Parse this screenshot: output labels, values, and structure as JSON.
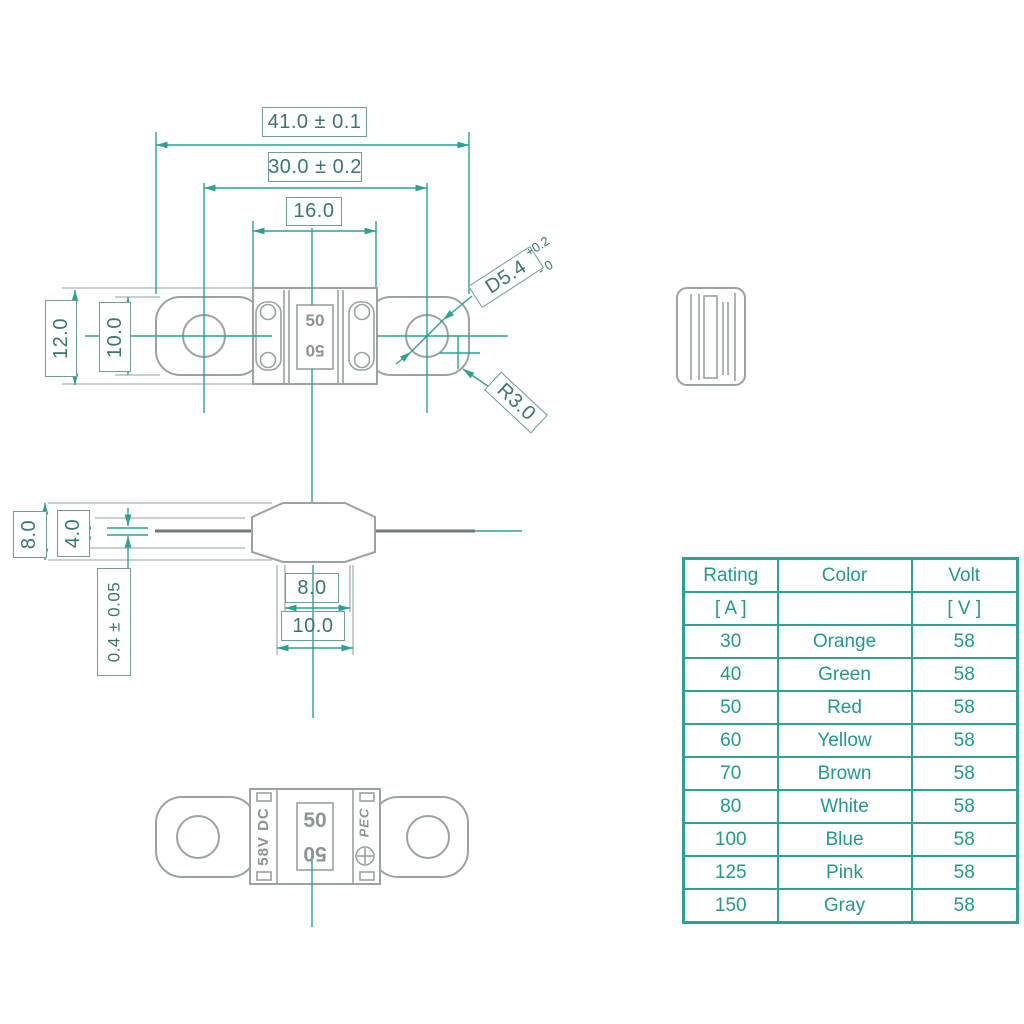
{
  "colors": {
    "teal": "#2fa094",
    "teal_text": "#22998d",
    "dim_text": "#3a7571",
    "gray": "#9aa2a2"
  },
  "drawing": {
    "top_view": {
      "dim_overall_length": "41.0 ± 0.1",
      "dim_hole_spacing": "30.0 ± 0.2",
      "dim_body_width": "16.0",
      "dim_body_height": "12.0",
      "dim_terminal_height": "10.0",
      "hole_diameter": "D5.4",
      "hole_tol_plus": "+0.2",
      "hole_tol_minus": "- 0",
      "corner_radius": "R3.0",
      "marking": "50",
      "marking_mirrored": "50"
    },
    "side_view": {
      "dim_end_height": "8.0",
      "dim_inner_height": "4.0",
      "dim_blade_thickness": "0.4 ± 0.05",
      "dim_base_inner": "8.0",
      "dim_base_outer": "10.0"
    },
    "bottom_view": {
      "voltage_marking": "58V DC",
      "marking": "50",
      "marking_mirrored": "50",
      "brand": "PEC",
      "polarity_icon": "circle-plus"
    }
  },
  "table": {
    "col1_title": "Rating",
    "col1_unit": "[ A ]",
    "col2_title": "Color",
    "col2_unit": "",
    "col3_title": "Volt",
    "col3_unit": "[ V ]",
    "rows": [
      {
        "rating": "30",
        "color": "Orange",
        "volt": "58"
      },
      {
        "rating": "40",
        "color": "Green",
        "volt": "58"
      },
      {
        "rating": "50",
        "color": "Red",
        "volt": "58"
      },
      {
        "rating": "60",
        "color": "Yellow",
        "volt": "58"
      },
      {
        "rating": "70",
        "color": "Brown",
        "volt": "58"
      },
      {
        "rating": "80",
        "color": "White",
        "volt": "58"
      },
      {
        "rating": "100",
        "color": "Blue",
        "volt": "58"
      },
      {
        "rating": "125",
        "color": "Pink",
        "volt": "58"
      },
      {
        "rating": "150",
        "color": "Gray",
        "volt": "58"
      }
    ]
  }
}
